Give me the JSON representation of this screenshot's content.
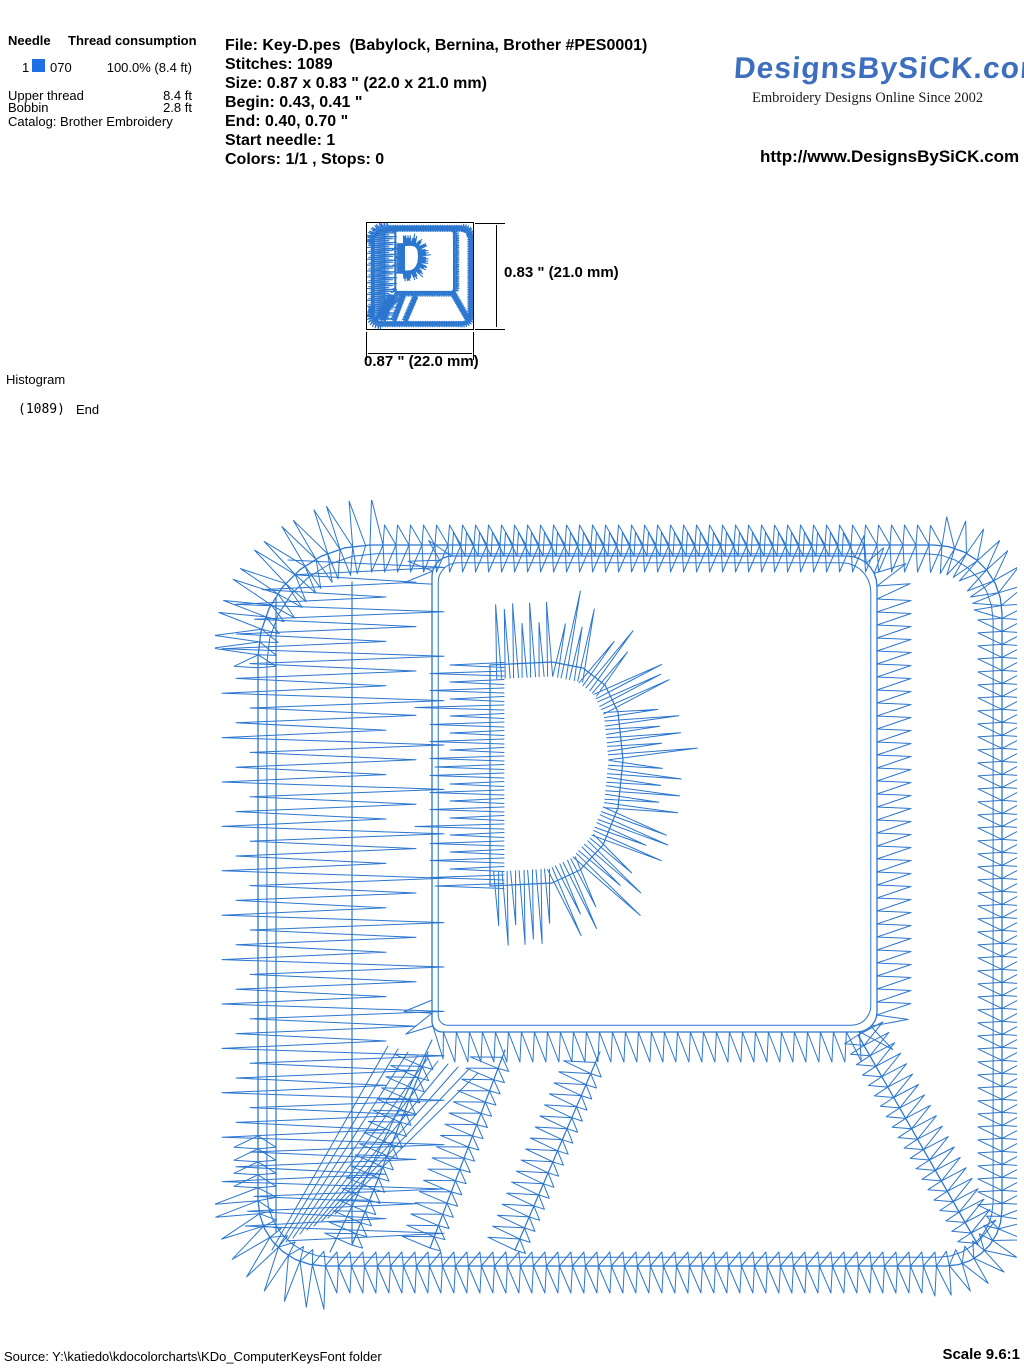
{
  "needle_table": {
    "header_needle": "Needle",
    "header_consumption": "Thread consumption",
    "row": {
      "needle": "1",
      "color_code": "070",
      "consumption": "100.0% (8.4 ft)",
      "swatch_color": "#1E6FE8"
    },
    "upper_thread_label": "Upper thread",
    "upper_thread_value": "8.4 ft",
    "bobbin_label": "Bobbin",
    "bobbin_value": "2.8 ft",
    "catalog": "Catalog: Brother Embroidery"
  },
  "file_info": {
    "lines": [
      "File: Key-D.pes  (Babylock, Bernina, Brother #PES0001)",
      "Stitches: 1089",
      "Size: 0.87 x 0.83 \" (22.0 x 21.0 mm)",
      "Begin: 0.43, 0.41 \"",
      "End: 0.40, 0.70 \"",
      "Start needle: 1",
      "Colors: 1/1 , Stops: 0"
    ]
  },
  "brand": {
    "logo_text": "DesignsBySiCK.com",
    "tagline": "Embroidery Designs Online Since 2002",
    "url": "http://www.DesignsBySiCK.com",
    "logo_color": "#3E6FBE"
  },
  "thumbnail": {
    "height_label": "0.83 \" (21.0 mm)",
    "width_label": "0.87 \" (22.0 mm)"
  },
  "histogram": {
    "title": "Histogram",
    "stitch_count": "(1089)",
    "end_label": "End"
  },
  "footer": {
    "source": "Source: Y:\\katiedo\\kdocolorcharts\\KDo_ComputerKeysFont folder",
    "scale": "Scale 9.6:1"
  },
  "design": {
    "stitch_color": "#2B76CF",
    "geometry": {
      "view_box": [
        215,
        500,
        802,
        810
      ],
      "outer": {
        "x0": 258,
        "y0": 545,
        "x1": 1002,
        "y1": 1266,
        "r": [
          112,
          68,
          56,
          66
        ]
      },
      "inner": {
        "x0": 432,
        "y0": 556,
        "x1": 877,
        "y1": 1032,
        "r": [
          20,
          30,
          20,
          10
        ]
      },
      "letter_d": [
        [
          490,
          886
        ],
        [
          490,
          665
        ],
        [
          552,
          662
        ],
        [
          583,
          668
        ],
        [
          605,
          685
        ],
        [
          618,
          712
        ],
        [
          623,
          760
        ],
        [
          618,
          808
        ],
        [
          603,
          845
        ],
        [
          580,
          870
        ],
        [
          552,
          883
        ],
        [
          490,
          886
        ]
      ],
      "stripes": [
        [
          [
            352,
            1245
          ],
          [
            428,
            1052
          ]
        ],
        [
          [
            430,
            1248
          ],
          [
            505,
            1050
          ]
        ],
        [
          [
            515,
            1250
          ],
          [
            600,
            1052
          ]
        ]
      ],
      "left_band": {
        "x0": 222,
        "x1": 436,
        "y0": 560,
        "y1": 1246,
        "step": 7.4
      },
      "vertical_contours": [
        [
          276,
          598,
          1232
        ],
        [
          352,
          582,
          1243
        ]
      ],
      "trapezoid_left": [
        [
          432,
          1040
        ],
        [
          330,
          1252
        ]
      ],
      "trapezoid_right": [
        [
          858,
          1035
        ],
        [
          978,
          1245
        ]
      ]
    }
  }
}
